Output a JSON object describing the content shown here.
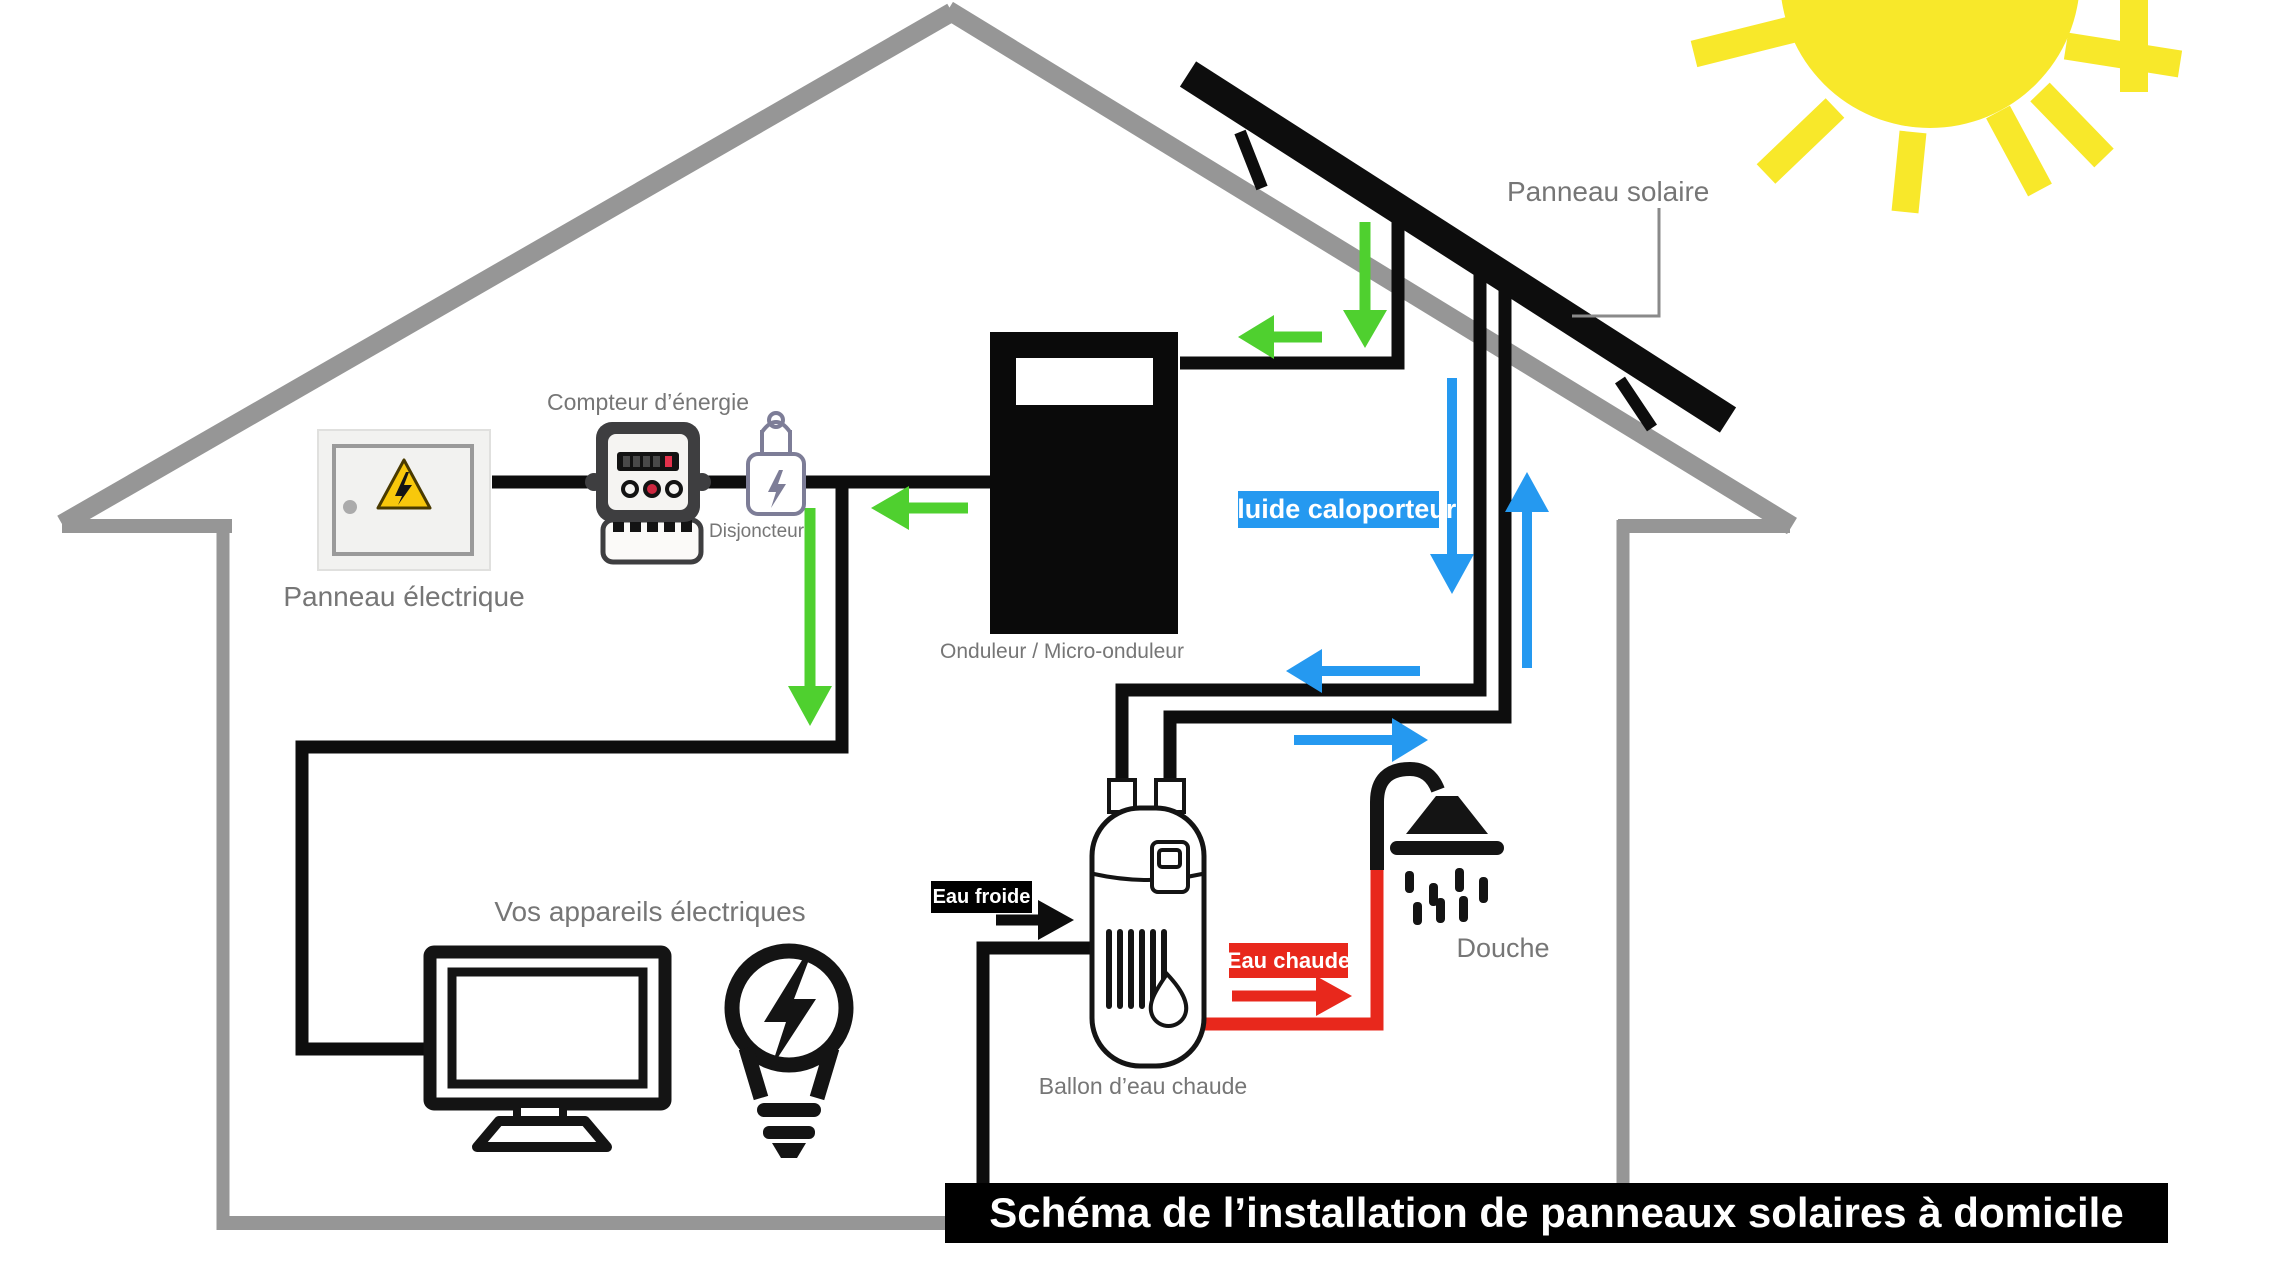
{
  "title": {
    "text": "Schéma de l’installation de panneaux solaires à domicile",
    "bg": "#000000",
    "color": "#FFFFFF"
  },
  "labels": {
    "panneau_solaire": "Panneau solaire",
    "compteur": "Compteur d’énergie",
    "disjoncteur": "Disjoncteur",
    "panneau_electrique": "Panneau électrique",
    "onduleur": "Onduleur / Micro-onduleur",
    "ballon": "Ballon d’eau chaude",
    "douche": "Douche",
    "appareils": "Vos appareils électriques"
  },
  "badges": {
    "fluide_caloporteur": {
      "text": "Fluide caloporteur",
      "bg": "#2599F0",
      "color": "#FFFFFF"
    },
    "eau_froide": {
      "text": "Eau froide",
      "bg": "#000000",
      "color": "#FFFFFF"
    },
    "eau_chaude": {
      "text": "Eau chaude",
      "bg": "#E8281C",
      "color": "#FFFFFF"
    }
  },
  "colors": {
    "sun_yellow": "#F8E82A",
    "house_gray": "#969696",
    "electricity_arrow_green": "#4FD02F",
    "fluid_arrow_blue": "#2599F0",
    "hot_water_red": "#E8281C",
    "wire_black": "#0D0D0D",
    "label_text_gray": "#767676",
    "warning_triangle_yellow": "#F8C80C"
  },
  "icons": {
    "sun": "sun-icon",
    "solar_panel": "solar-panel-icon",
    "energy_meter": "energy-meter-icon",
    "circuit_breaker": "circuit-breaker-icon",
    "electrical_panel": "electrical-panel-icon",
    "warning_triangle": "warning-triangle-icon",
    "inverter": "inverter-icon",
    "water_heater": "water-heater-icon",
    "shower": "shower-icon",
    "monitor": "monitor-icon",
    "lightbulb": "lightbulb-icon"
  }
}
